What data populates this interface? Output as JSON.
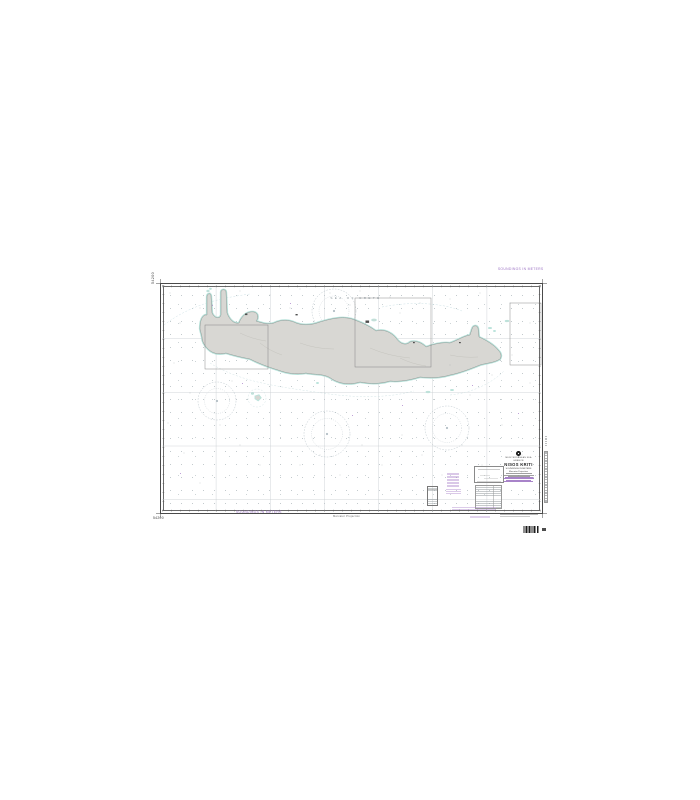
{
  "chart": {
    "kind": "nautical-chart-product-photo",
    "number": "54200",
    "sea_label": "SEA OF CRETE",
    "soundings_note": "SOUNDINGS IN METERS",
    "projection_note": "Mercator Projection",
    "title_block": {
      "region_line": "MEDITERRANEAN SEA",
      "country_line": "GREECE",
      "title": "NISOS KRITI",
      "soundings_line": "SOUNDINGS IN METERS",
      "projection_line": "Mercator Projection"
    },
    "colors": {
      "page_background": "#ffffff",
      "land": "#d8d7d3",
      "shallow_water": "#b9e3db",
      "coastline": "#8f9795",
      "graticule": "#c5cbce",
      "neatline": "#4a4a4a",
      "magenta_overprint": "#9d74c4"
    }
  }
}
